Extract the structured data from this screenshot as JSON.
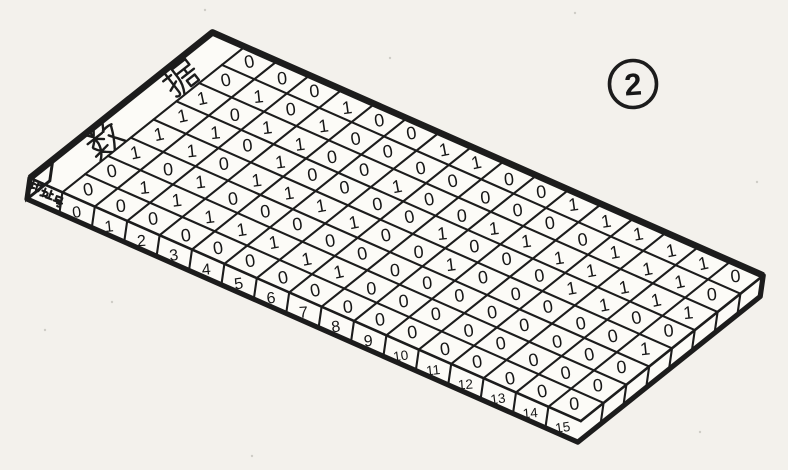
{
  "figure": {
    "badge": "2",
    "board": {
      "top_face_label": "数据",
      "front_face_label": "地址号",
      "columns": 8,
      "rows": [
        {
          "address": "0",
          "bits": "00111100"
        },
        {
          "address": "1",
          "bits": "01011010"
        },
        {
          "address": "2",
          "bits": "01100100"
        },
        {
          "address": "3",
          "bits": "01011111"
        },
        {
          "address": "4",
          "bits": "01010000"
        },
        {
          "address": "5",
          "bits": "01010000"
        },
        {
          "address": "6",
          "bits": "01010101"
        },
        {
          "address": "7",
          "bits": "01000001"
        },
        {
          "address": "8",
          "bits": "00001000"
        },
        {
          "address": "9",
          "bits": "00010100"
        },
        {
          "address": "10",
          "bits": "00000101"
        },
        {
          "address": "11",
          "bits": "00000101"
        },
        {
          "address": "12",
          "bits": "00001111"
        },
        {
          "address": "13",
          "bits": "00001111"
        },
        {
          "address": "14",
          "bits": "00000111"
        },
        {
          "address": "15",
          "bits": "00010100"
        }
      ]
    },
    "colors": {
      "ink": "#1c1c1c",
      "paper": "#f3f1ec",
      "face": "#fcfbf7"
    }
  }
}
